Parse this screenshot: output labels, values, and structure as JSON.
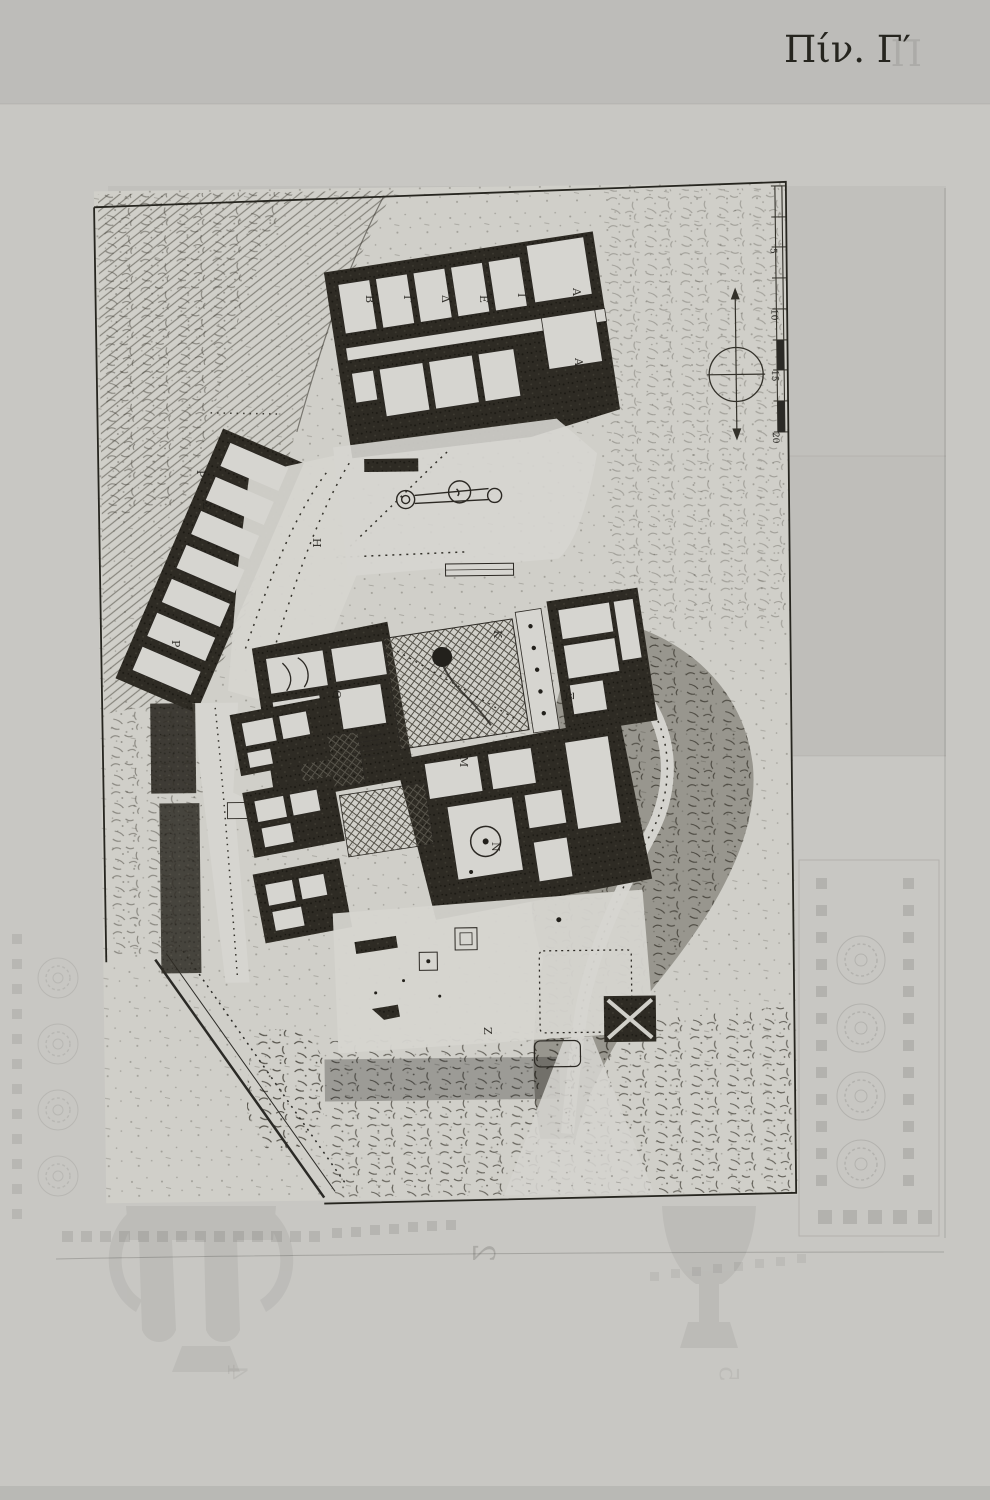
{
  "page": {
    "plate_label": "Πίν. Γ′",
    "ghost_letter": "Π",
    "background_color": "#c8c7c3",
    "ink_color": "#26251f"
  },
  "plate": {
    "kind": "engraved-archaeological-site-plan",
    "paper_color": "#d0cfc9",
    "wall_ink_color": "#2b2823"
  },
  "plan": {
    "room_labels": [
      {
        "t": "Β"
      },
      {
        "t": "Γ"
      },
      {
        "t": "Δ"
      },
      {
        "t": "Ε"
      },
      {
        "t": "Ι"
      },
      {
        "t": "Α"
      },
      {
        "t": "Α"
      },
      {
        "t": "Η"
      },
      {
        "t": "Ρ"
      },
      {
        "t": "Σ"
      },
      {
        "t": "Ρ"
      },
      {
        "t": "Θ"
      },
      {
        "t": "Κ"
      },
      {
        "t": "Μ"
      },
      {
        "t": "Ν"
      },
      {
        "t": "Ξ"
      },
      {
        "t": "Ζ"
      }
    ],
    "scale_bar": {
      "tick_labels": [
        "5",
        "10",
        "15",
        "20"
      ]
    },
    "compass_icon": "north-arrow"
  },
  "bleed_through": {
    "digits": [
      "2",
      "4",
      "5"
    ]
  }
}
